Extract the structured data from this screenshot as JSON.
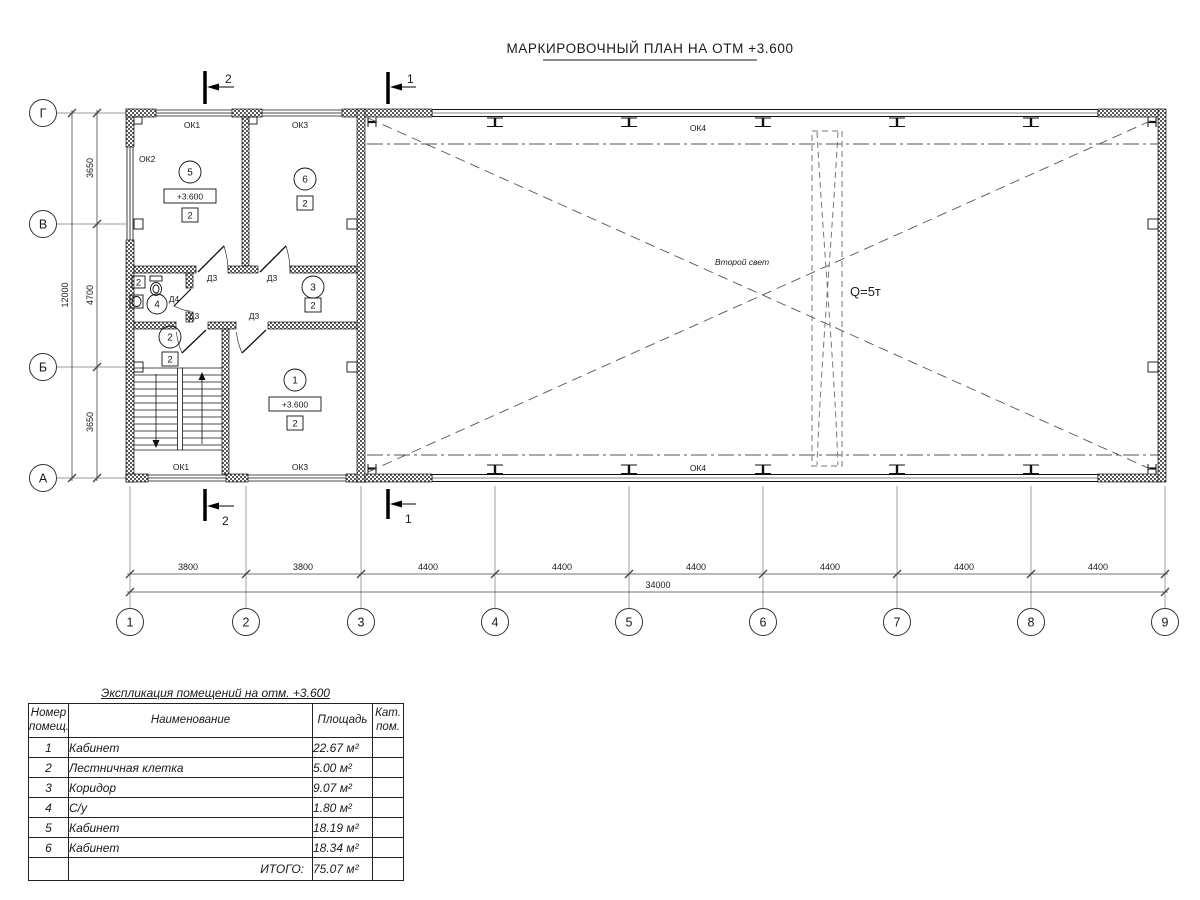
{
  "title": "МАРКИРОВОЧНЫЙ ПЛАН НА ОТМ +3.600",
  "plan": {
    "grid_cols": [
      "1",
      "2",
      "3",
      "4",
      "5",
      "6",
      "7",
      "8",
      "9"
    ],
    "grid_rows": [
      "Г",
      "В",
      "Б",
      "А"
    ],
    "dims_h": [
      "3800",
      "3800",
      "4400",
      "4400",
      "4400",
      "4400",
      "4400",
      "4400"
    ],
    "dim_h_total": "34000",
    "dims_v": [
      "3650",
      "4700",
      "3650"
    ],
    "dim_v_total": "12000",
    "section_1": "1",
    "section_2": "2",
    "win_ok1": "ОК1",
    "win_ok2": "ОК2",
    "win_ok3": "ОК3",
    "win_ok4": "ОК4",
    "door_d3": "Д3",
    "door_d4": "Д4",
    "elev_mark": "+3.600",
    "cat_mark": "2",
    "room_1": "1",
    "room_2": "2",
    "room_3": "3",
    "room_4": "4",
    "room_5": "5",
    "room_6": "6",
    "second_light": "Второй свет",
    "crane_capacity": "Q=5т"
  },
  "table": {
    "title": "Экспликация помещений на отм. +3.600",
    "col_num_l1": "Номер",
    "col_num_l2": "помещ.",
    "col_name": "Наименование",
    "col_area": "Площадь",
    "col_cat_l1": "Кат.",
    "col_cat_l2": "пом.",
    "rows": [
      {
        "num": "1",
        "name": "Кабинет",
        "area": "22.67 м²"
      },
      {
        "num": "2",
        "name": "Лестничная клетка",
        "area": "5.00 м²"
      },
      {
        "num": "3",
        "name": "Коридор",
        "area": "9.07 м²"
      },
      {
        "num": "4",
        "name": "С/у",
        "area": "1.80 м²"
      },
      {
        "num": "5",
        "name": "Кабинет",
        "area": "18.19 м²"
      },
      {
        "num": "6",
        "name": "Кабинет",
        "area": "18.34 м²"
      }
    ],
    "total_label": "ИТОГО:",
    "total_area": "75.07 м²"
  }
}
